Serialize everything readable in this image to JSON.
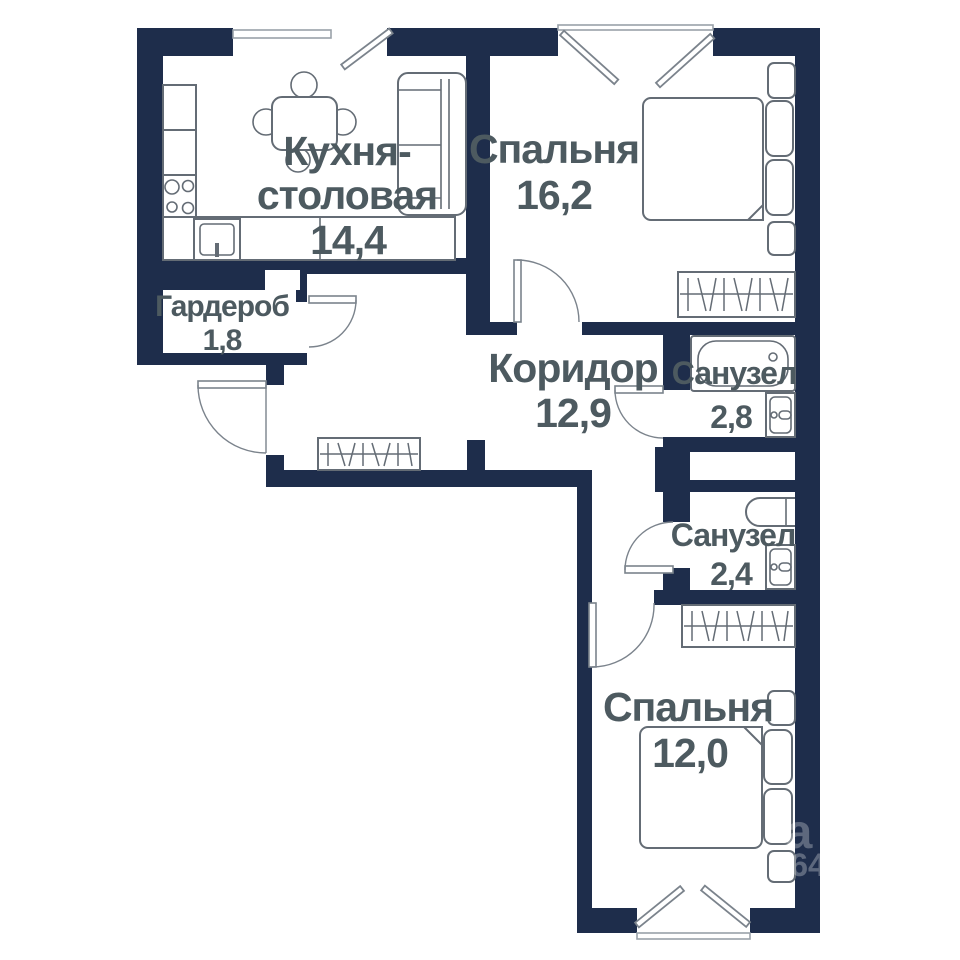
{
  "rooms": {
    "kitchen": {
      "line1": "Кухня-",
      "line2": "столовая",
      "area": "14,4"
    },
    "bedroom_top": {
      "name": "Спальня",
      "area": "16,2"
    },
    "wardrobe_room": {
      "name": "Гардероб",
      "area": "1,8"
    },
    "corridor": {
      "name": "Коридор",
      "area": "12,9"
    },
    "bathroom_top": {
      "name": "Санузел",
      "area": "2,8"
    },
    "bathroom_bottom": {
      "name": "Санузел",
      "area": "2,4"
    },
    "bedroom_bottom": {
      "name": "Спальня",
      "area": "12,0"
    }
  },
  "watermark": {
    "letter": "а",
    "digits": "64"
  },
  "colors": {
    "wall": "#1e2d4b",
    "label_text": "#4d5a60",
    "fixture_line": "#646c75",
    "background": "#ffffff"
  }
}
